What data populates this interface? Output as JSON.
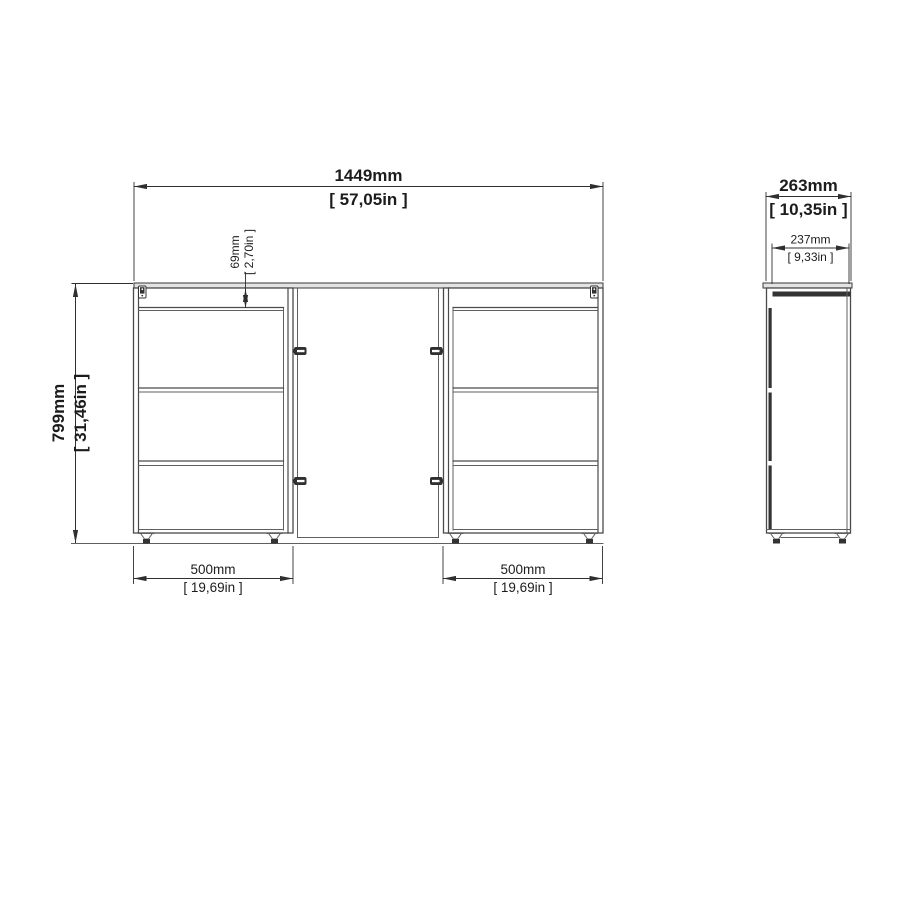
{
  "drawing": {
    "type": "furniture-dimension-diagram",
    "views": {
      "front": {
        "label": "front-view",
        "overall_width": {
          "mm": "1449mm",
          "in": "[ 57,05in ]"
        },
        "overall_height": {
          "mm": "799mm",
          "in": "[ 31,46in ]"
        },
        "apron_height": {
          "mm": "69mm",
          "in": "[ 2,70in ]"
        },
        "left_pedestal_width": {
          "mm": "500mm",
          "in": "[ 19,69in ]"
        },
        "right_pedestal_width": {
          "mm": "500mm",
          "in": "[ 19,69in ]"
        },
        "drawers_per_pedestal": 3
      },
      "side": {
        "label": "side-view",
        "overall_depth": {
          "mm": "263mm",
          "in": "[ 10,35in ]"
        },
        "body_depth": {
          "mm": "237mm",
          "in": "[ 9,33in ]"
        }
      }
    },
    "icons": {
      "cam_lock": "cam-lock-icon",
      "foot_glide": "foot-glide-icon",
      "connector": "connector-bracket-icon"
    },
    "colors": {
      "line": "#4a4a4a",
      "line_dark": "#2f2f2f",
      "fill_dark": "#333333",
      "surface_fill": "#e3e3e3",
      "text": "#1c1c1c",
      "background": "#ffffff"
    }
  }
}
